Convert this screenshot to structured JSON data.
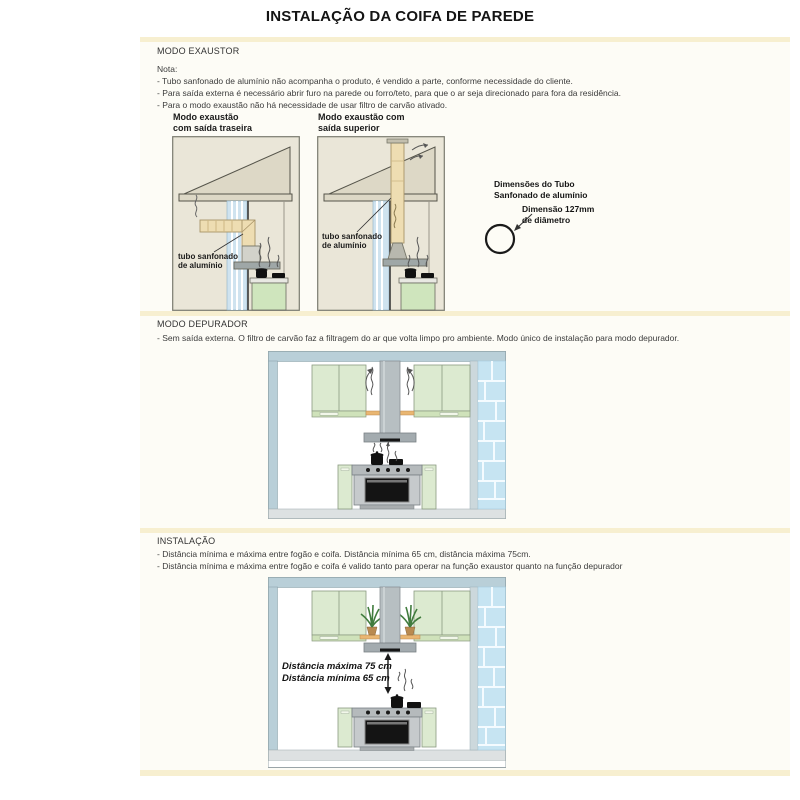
{
  "doc": {
    "title": "INSTALAÇÃO DA COIFA DE PAREDE"
  },
  "exaustor": {
    "header": "MODO EXAUSTOR",
    "note_label": "Nota:",
    "notes": [
      "- Tubo sanfonado de alumínio não acompanha o produto, é vendido a parte, conforme necessidade do cliente.",
      "- Para saída externa é necessário abrir furo na parede ou forro/teto, para que o ar seja direcionado para fora da residência.",
      "- Para o modo exaustão não há necessidade de usar filtro de carvão ativado."
    ],
    "diagram_rear_title_1": "Modo exaustão",
    "diagram_rear_title_2": "com saída traseira",
    "diagram_top_title_1": "Modo exaustão com",
    "diagram_top_title_2": "saída superior",
    "duct_label_1": "tubo sanfonado",
    "duct_label_2": "de alumínio",
    "dims_heading_1": "Dimensões do Tubo",
    "dims_heading_2": "Sanfonado de alumínio",
    "dims_value_1": "Dimensão 127mm",
    "dims_value_2": "de diâmetro"
  },
  "depurador": {
    "header": "MODO DEPURADOR",
    "description": "- Sem saída externa. O filtro de carvão faz a filtragem do ar que volta limpo pro ambiente. Modo único de instalação para modo depurador."
  },
  "instalacao": {
    "header": "INSTALAÇÃO",
    "notes": [
      "- Distância mínima e máxima entre fogão e coifa. Distância mínima 65 cm, distância máxima 75cm.",
      "- Distância mínima e máxima entre fogão e coifa é valido tanto para operar na função exaustor quanto na função depurador"
    ],
    "distance_max": "Distância máxima 75 cm",
    "distance_min": "Distância mínima 65 cm"
  },
  "colors": {
    "divider_band": "#f7efd0",
    "house_beige": "#eae6d8",
    "duct_beige": "#eeddb2",
    "pipe_blue": "#cfe3ef",
    "cabinet_green": "#dcead0",
    "brick_blue": "#c6e4f2",
    "hood_gray": "#a3abaf",
    "wall_blue_gray": "#b9cfd8",
    "shelf_orange": "#e9b672"
  }
}
